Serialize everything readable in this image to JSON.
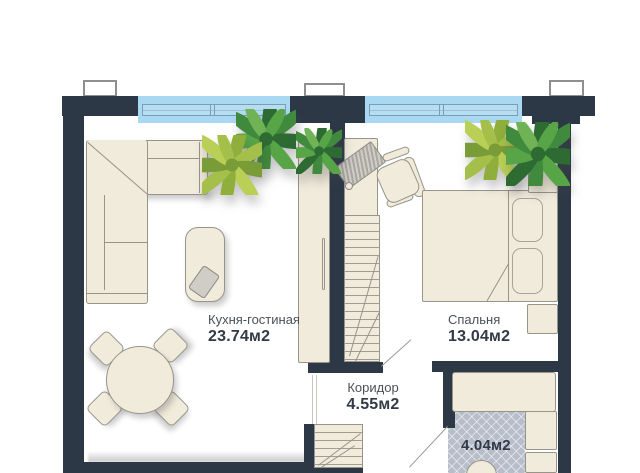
{
  "title": "Apartment floor plan",
  "rooms": {
    "kitchen": {
      "name": "Кухня-гостиная",
      "area": "23.74м2"
    },
    "bedroom": {
      "name": "Спальня",
      "area": "13.04м2"
    },
    "corridor": {
      "name": "Коридор",
      "area": "4.55м2"
    },
    "bathroom": {
      "area": "4.04м2"
    }
  },
  "colors": {
    "wall": "#2d3847",
    "window_glass": "#a9d9f2",
    "window_frame": "#7d9db2",
    "furniture": "#f0ebdb",
    "furniture_outline": "#98948a",
    "tile_floor": "#b7bdc9",
    "plant_dark": "#2d6b33",
    "plant_light": "#9ab33f",
    "label_text": "#4b5058",
    "area_text": "#323947",
    "door_line": "#9a9a96"
  },
  "furniture": [
    "corner-sofa",
    "coffee-table",
    "round-dining-table",
    "dining-chair",
    "tall-cabinet",
    "wardrobe-with-rail",
    "desk",
    "office-chair",
    "laptop",
    "double-bed",
    "pillow",
    "nightstand",
    "plant",
    "bathtub",
    "washing-machine",
    "sink",
    "toilet"
  ]
}
